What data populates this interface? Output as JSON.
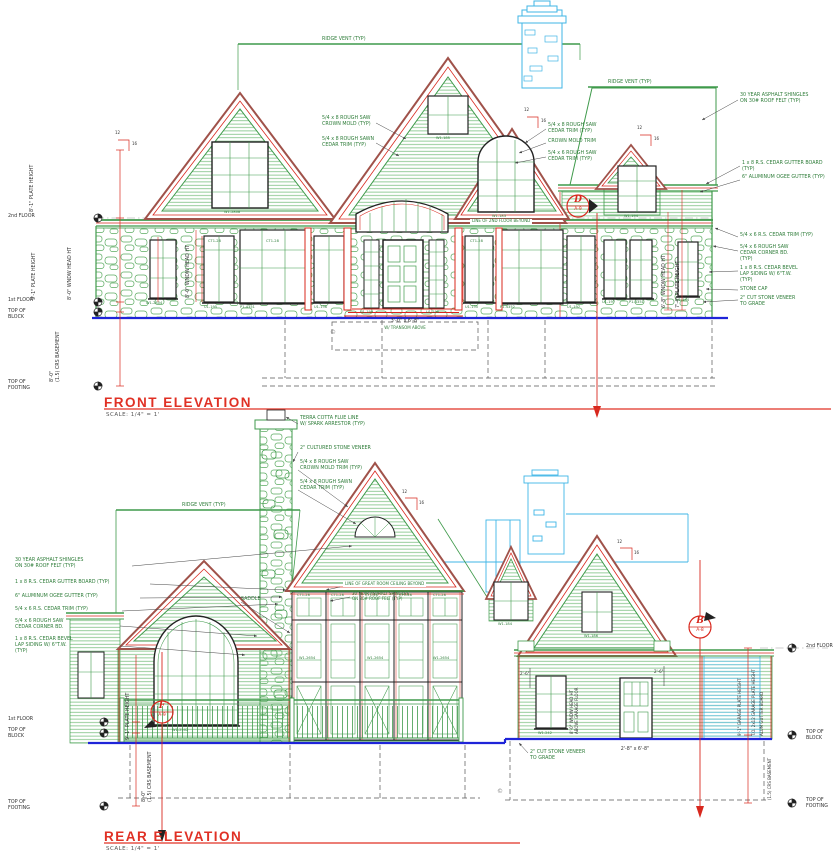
{
  "colors": {
    "green": "#3f9a4b",
    "siding_green": "#7cbf81",
    "red": "#e03024",
    "dim_red": "#d8281e",
    "trim_brown": "#a0524a",
    "cyan": "#3fb5e6",
    "grade_blue": "#1f24d8",
    "black": "#222222"
  },
  "front": {
    "title": "FRONT ELEVATION",
    "scale": "SCALE:  1/4\" = 1'",
    "ridge_vent": "RIDGE VENT (TYP)",
    "notes_right": [
      "30 YEAR ASPHALT SHINGLES\nON 30# ROOF FELT (TYP)",
      "1 x 8 R.S. CEDAR GUTTER BOARD (TYP)",
      "6\" ALUMINUM OGEE GUTTER (TYP)",
      "5/4 x 6 R.S. CEDAR TRIM (TYP)",
      "5/4 x 6 ROUGH SAW\nCEDAR CORNER BD.\n(TYP)",
      "1 x 8 R.S. CEDAR BEVEL\nLAP SIDING W/ 6\"T.W.\n(TYP)",
      "STONE CAP",
      "2\" CUT STONE VENEER\nTO GRADE"
    ],
    "notes_gable_left": [
      "5/4 x 8 ROUGH SAW\nCROWN MOLD (TYP)",
      "5/4 x 8 ROUGH SAWN\nCEDAR TRIM (TYP)"
    ],
    "notes_gable_right": [
      "5/4 x 8 ROUGH SAW\nCEDAR TRIM (TYP)",
      "CROWN MOLD TRIM",
      "5/4 x 6 ROUGH SAW\nCEDAR TRIM (TYP)"
    ],
    "note_2nd_floor_line": "LINE OF 2ND FLOOR BEYOND",
    "dims": {
      "plate_upper": "8'-1\" PLATE HEIGHT",
      "plate_main": "9'-1\" PLATE HEIGHT",
      "wndw_head": "8'-0\" WNDW HEAD HT",
      "basement": "8'-0\"\n(1.5) CRS BASEMENT",
      "dormer_head": "6'-8\" WNDW HEAD HT",
      "dormer_plate": "7'-4\" PLATE HEIGHT",
      "door": "3'-0\" x 6'-8\"",
      "door_sub": "W/ TRANSOM ABOVE"
    },
    "floors": {
      "second": "2nd FLOOR",
      "first": "1st FLOOR",
      "top_block": "TOP OF\nBLOCK",
      "top_footing": "TOP OF\nFOOTING"
    },
    "marker_d": {
      "letter": "D",
      "sheet": "A-9"
    },
    "pitch": {
      "rise": "12",
      "run": "16"
    },
    "windows": {
      "w1": "W1-2804",
      "u1": "U1-195",
      "p1": "P1-4351",
      "u2": "U1-196",
      "u3": "U1-199",
      "u4": "U1-198",
      "u5": "U1-195",
      "p2": "P1-4352",
      "u6": "U1-197",
      "pair1": "U1-197",
      "pair2": "P1-4351",
      "single": "U1-194",
      "g_left": "W1-2808",
      "g_mid": "W1-183",
      "g_top": "W1-185",
      "dormer": "W1-194",
      "transom": "CT1-28"
    },
    "copyright": "©"
  },
  "rear": {
    "title": "REAR ELEVATION",
    "scale": "SCALE:  1/4\" = 1'",
    "ridge_vent": "RIDGE VENT (TYP)",
    "notes_chimney": [
      "TERRA COTTA FLUE LINE\nW/ SPARK ARRESTOR (TYP)",
      "2\" CULTURED STONE VENEER"
    ],
    "notes_crown": [
      "5/4 x 8 ROUGH SAW\nCROWN MOLD TRIM (TYP)",
      "5/4 x 8 ROUGH SAWN\nCEDAR TRIM (TYP)"
    ],
    "notes_left": [
      "30 YEAR ASPHALT SHINGLES\nON 30# ROOF FELT (TYP)",
      "1 x 8 R.S. CEDAR GUTTER BOARD (TYP)",
      "6\" ALUMINUM OGEE GUTTER (TYP)",
      "5/4 x 6 R.S. CEDAR TRIM (TYP)",
      "5/4 x 6 ROUGH SAW\nCEDAR CORNER BD.",
      "1 x 8 R.S. CEDAR BEVEL\nLAP SIDING W/ 6\"T.W.\n(TYP)"
    ],
    "note_great_room": "LINE OF GREAT ROOM CEILING BEYOND",
    "note_saddle": "SADDLE",
    "note_stone": "2\" CUT STONE VENEER\nTO GRADE",
    "dims": {
      "door": "2'-8\" x 6'-8\"",
      "plate_main": "9'-1\" PLATE HEIGHT",
      "basement": "8'-0\"\n(1.5) CRS BASEMENT",
      "garage_plate": "9'-1\" GARAGE PLATE HEIGHT",
      "garage_to": "T.O. 2x12 GARAGE PLATE HEIGHT",
      "gutter_board": "ALUM GUTTER BOARD",
      "crs_basement": "(1.5) CRS BASEMENT",
      "garage_head": "8'-0\" WNDW HEAD HT\nABOVE GARAGE FLOOR",
      "eave": "2'-6\""
    },
    "floors": {
      "second": "2nd FLOOR",
      "first": "1st FLOOR",
      "top_block": "TOP OF\nBLOCK",
      "top_footing": "TOP OF\nFOOTING"
    },
    "marker_b": {
      "letter": "B",
      "sheet": "A-8"
    },
    "marker_f": {
      "letter": "F",
      "sheet": "A-9"
    },
    "pitch": {
      "rise": "12",
      "run": "16"
    },
    "windows": {
      "arch": "W1-2502",
      "garage": "W1-242",
      "dormer": "W1-184",
      "gable": "W1-186",
      "grid_top": "CT1-28",
      "grid_mid": "W1-2654"
    },
    "copyright": "©"
  }
}
